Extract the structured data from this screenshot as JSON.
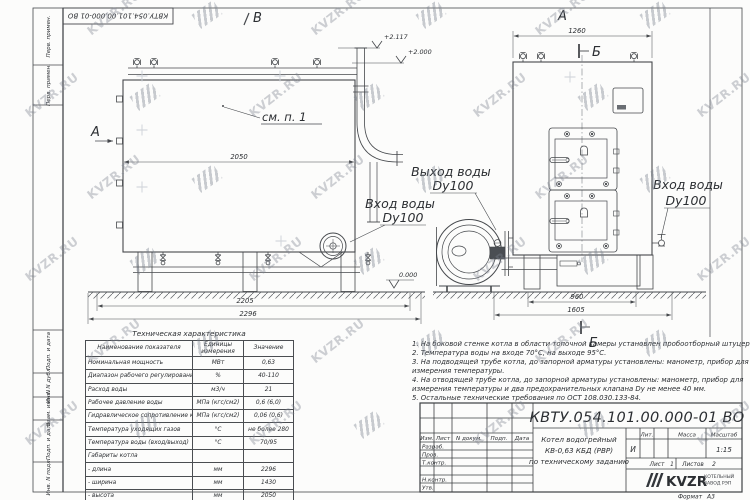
{
  "doc_number": "КВТУ.054.101.00.000-01 ВО",
  "watermark": {
    "text": "KVZR.RU"
  },
  "stamps": {
    "top": [
      "Перв. примен.",
      "Перв. примен."
    ],
    "bottom": [
      "Подп. и дата",
      "Инв. N дубл.",
      "Взам. инв. N",
      "Подп. и дата",
      "Инв. N подл."
    ]
  },
  "drawing": {
    "view_labels": {
      "v": "В",
      "a_top": "А",
      "a_side": "А",
      "b_top": "Б",
      "b_bottom": "Б"
    },
    "see_note": "см. п. 1",
    "elevations": {
      "top1": "+2.117",
      "top2": "+2.000",
      "ground": "0.000"
    },
    "dimensions": {
      "side_width": "2050",
      "base_inner": "2205",
      "base_outer": "2296",
      "front_width": "1260",
      "front_base_inner": "960",
      "front_base_outer": "1605"
    },
    "ports": {
      "outlet_label": "Выход воды",
      "outlet_size": "Dy100",
      "inlet_label": "Вход воды",
      "inlet_size": "Dy100",
      "inlet2_label": "Вход воды",
      "inlet2_size": "Dy100"
    }
  },
  "tech_table": {
    "title": "Техническая характеристика",
    "headers": [
      "Наименование показателя",
      "Единицы измерения",
      "Значение"
    ],
    "rows": [
      {
        "name": "Номинальная мощность",
        "unit": "МВт",
        "value": "0,63"
      },
      {
        "name": "Диапазон рабочего регулирования",
        "unit": "%",
        "value": "40-110"
      },
      {
        "name": "Расход воды",
        "unit": "м3/ч",
        "value": "21"
      },
      {
        "name": "Рабочее давление воды",
        "unit": "МПа (кгс/см2)",
        "value": "0,6 (6,0)"
      },
      {
        "name": "Гидравлическое сопротивление котла",
        "unit": "МПа (кгс/см2)",
        "value": "0,06 (0,6)"
      },
      {
        "name": "Температура уходящих газов",
        "unit": "°С",
        "value": "не более 280"
      },
      {
        "name": "Температура воды (вход/выход)",
        "unit": "°С",
        "value": "70/95"
      },
      {
        "name": "Габариты котла",
        "unit": "",
        "value": ""
      },
      {
        "name": "- длина",
        "unit": "мм",
        "value": "2296"
      },
      {
        "name": "- ширина",
        "unit": "мм",
        "value": "1430"
      },
      {
        "name": "- высота",
        "unit": "мм",
        "value": "2050"
      }
    ]
  },
  "notes": {
    "lines": [
      "1. На боковой стенке котла в области топочной камеры установлен пробоотборный штуцер",
      "2. Температура воды на входе 70°С, на выходе 95°С.",
      "3. На подводящей трубе котла, до запорной арматуры установлены: манометр, прибор для",
      "измерения температуры.",
      "4. На отводящей трубе котла, до запорной арматуры установлены: манометр, прибор для",
      "измерения температуры и два предохранительных клапана Dу не менее 40 мм.",
      "5. Остальные технические требования по ОСТ 108.030.133-84."
    ]
  },
  "title_block": {
    "rev_headers": [
      "Изм.",
      "Лист",
      "N докум.",
      "Подп.",
      "Дата"
    ],
    "roles": [
      "Разраб.",
      "Пров.",
      "Т.контр.",
      "Н.контр.",
      "Утв."
    ],
    "title_lines": [
      "Котел водогрейный",
      "КВ-0,63 КБД (РВР)",
      "по техническому заданию"
    ],
    "lit_header": "Лит.",
    "mass_header": "Масса",
    "scale_header": "Масштаб",
    "lit_value": "И",
    "scale_value": "1:15",
    "sheet_label": "Лист",
    "sheet_value": "1",
    "sheets_label": "Листов",
    "sheets_value": "2",
    "logo_text": "KVZR",
    "org_line1": "КОТЕЛЬНЫЙ",
    "org_line2": "ЗАВОД РЭП",
    "format_label": "Формат",
    "format_value": "А3"
  }
}
